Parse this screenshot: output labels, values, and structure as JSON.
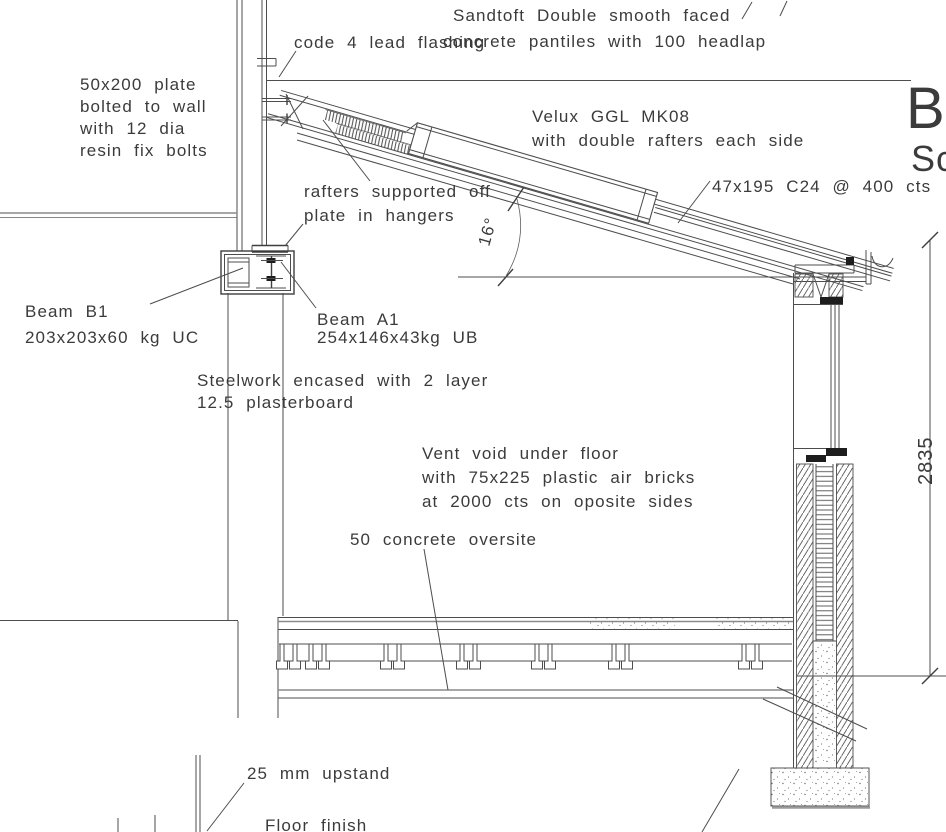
{
  "drawing": {
    "type": "building-section-detail",
    "colors": {
      "line": "#4d4d4d",
      "text": "#3b3b3b",
      "background": "#ffffff",
      "solid_fill": "#1d1d1d"
    },
    "title_fragments": {
      "letter_1": "B",
      "letter_2": "Sc"
    },
    "labels": {
      "pantiles": [
        "Sandtoft Double smooth faced",
        "concrete pantiles with 100 headlap"
      ],
      "flashing": "code 4 lead flashing",
      "plate": [
        "50x200 plate",
        "bolted to wall",
        "with 12 dia",
        "resin fix bolts"
      ],
      "velux": [
        "Velux GGL MK08",
        "with double rafters each side"
      ],
      "rafter_spec": "47x195 C24 @ 400 cts",
      "hangers": [
        "rafters supported off",
        "plate in hangers"
      ],
      "roof_angle": "16°",
      "beam_b1": [
        "Beam B1",
        "203x203x60 kg UC"
      ],
      "beam_a1": [
        "Beam A1",
        "254x146x43kg UB"
      ],
      "steelwork": [
        "Steelwork encased with 2 layer",
        "12.5 plasterboard"
      ],
      "vent": [
        "Vent void under floor",
        "with 75x225 plastic air bricks",
        "at 2000 cts on oposite sides"
      ],
      "oversite": "50 concrete oversite",
      "upstand": "25 mm upstand",
      "floor_finish": "Floor finish",
      "wall_height": "2835"
    }
  }
}
